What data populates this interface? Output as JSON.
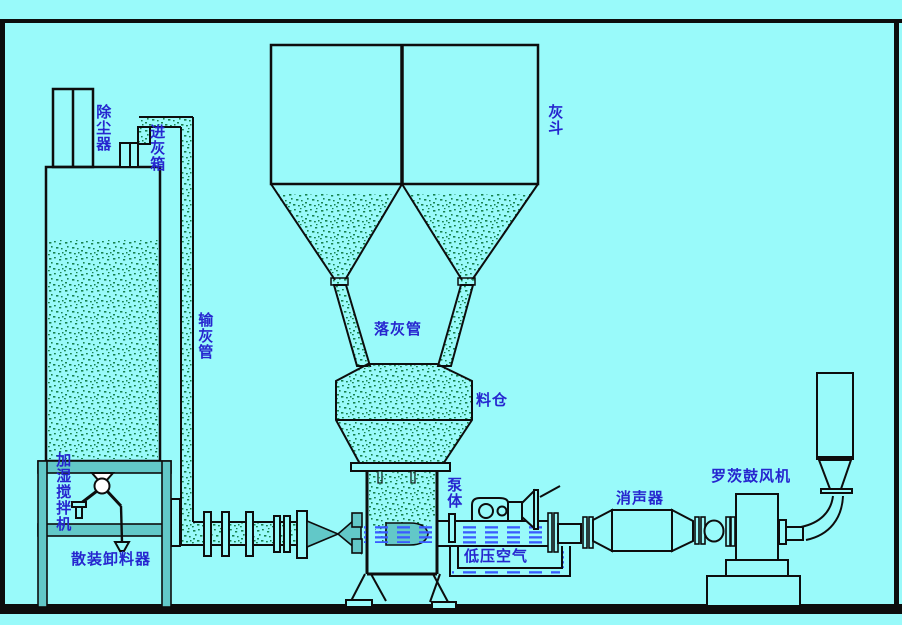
{
  "diagram": {
    "type": "process-schematic",
    "subject": "pneumatic ash conveying system",
    "colors": {
      "background": "#99FAFA",
      "line": "#0D0D0D",
      "label_text": "#2626CF",
      "ash_particles": "#17814E",
      "structure_teal": "#62C8C8",
      "air_dash_blue": "#3A5CFF",
      "ground_bar": "#0B0B0B"
    },
    "labels": {
      "dust_collector": {
        "text": "除尘器",
        "orientation": "vertical"
      },
      "ash_inlet_box": {
        "text": "进灰箱",
        "orientation": "vertical"
      },
      "ash_hopper": {
        "text": "灰斗",
        "orientation": "vertical"
      },
      "ash_conveying_pipe": {
        "text": "输灰管",
        "orientation": "vertical"
      },
      "ash_drop_pipe": {
        "text": "落灰管",
        "orientation": "horizontal"
      },
      "material_silo": {
        "text": "料仓",
        "orientation": "horizontal"
      },
      "pump_body": {
        "text": "泵体",
        "orientation": "vertical"
      },
      "low_pressure_air": {
        "text": "低压空气",
        "orientation": "horizontal"
      },
      "silencer": {
        "text": "消声器",
        "orientation": "horizontal"
      },
      "roots_blower": {
        "text": "罗茨鼓风机",
        "orientation": "horizontal"
      },
      "humidifying_mixer": {
        "text": "加湿搅拌机",
        "orientation": "vertical"
      },
      "bulk_unloader": {
        "text": "散装卸料器",
        "orientation": "horizontal"
      }
    }
  }
}
